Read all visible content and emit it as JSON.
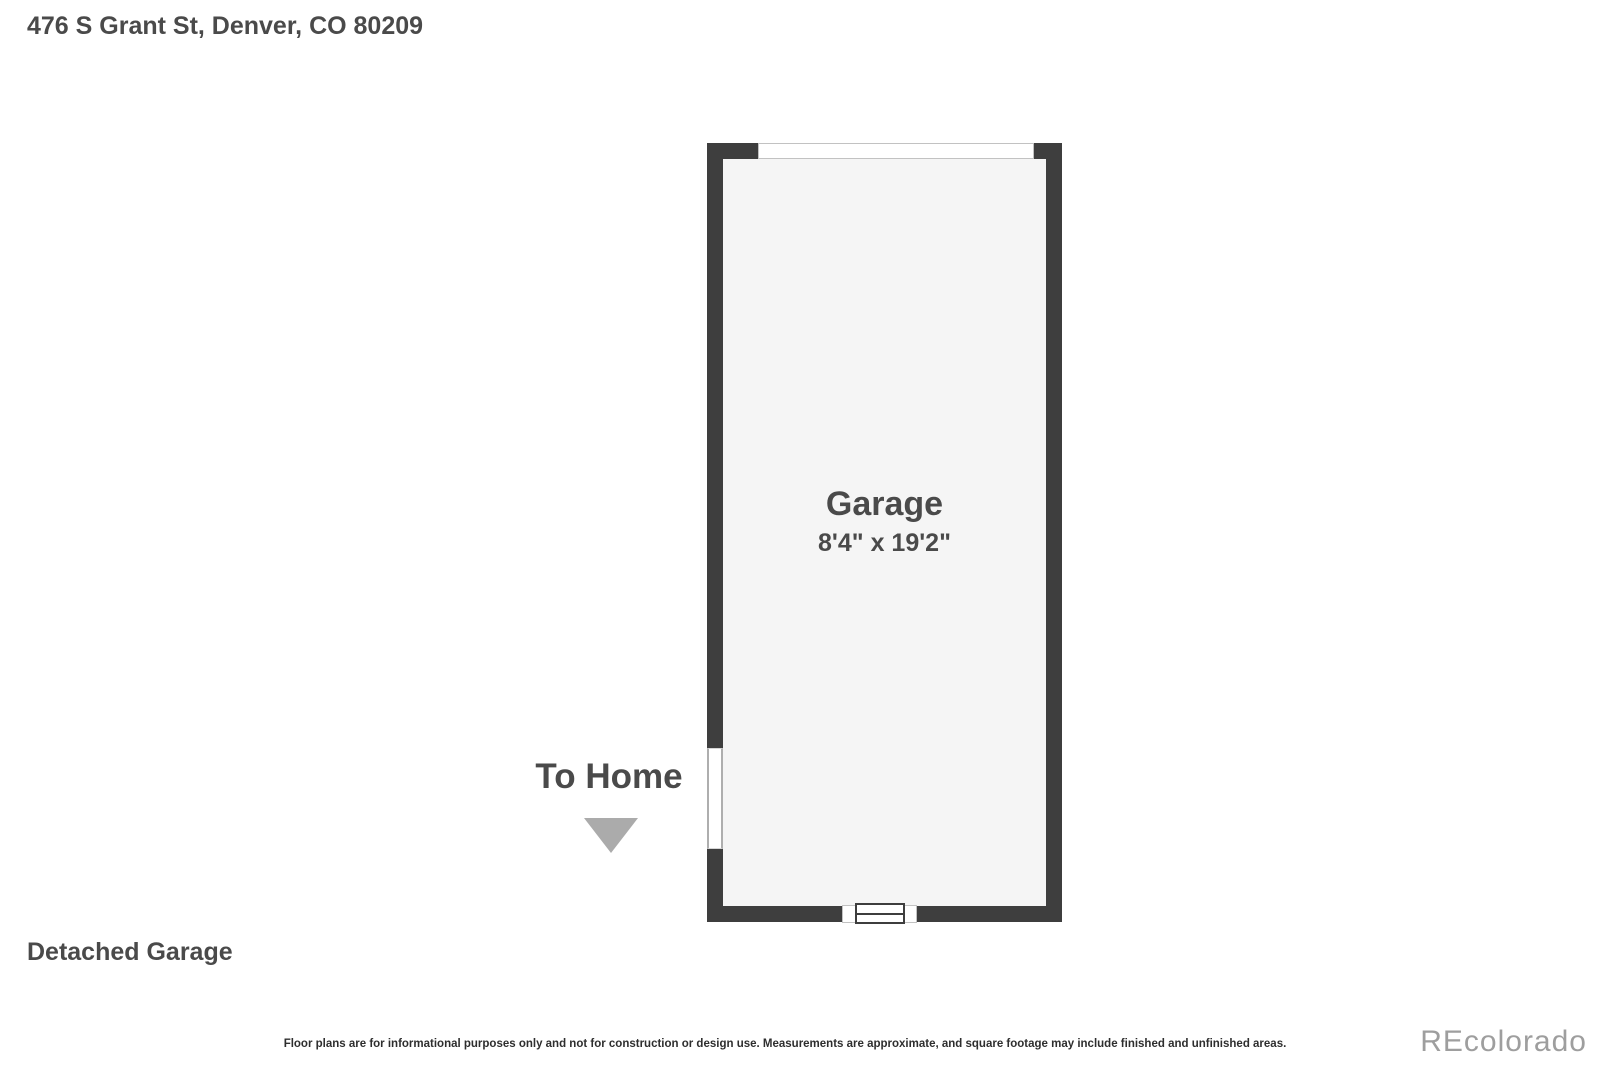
{
  "header": {
    "address": "476 S Grant St, Denver, CO 80209"
  },
  "floor_plan": {
    "room": {
      "name": "Garage",
      "dimensions": "8'4\" x 19'2\""
    },
    "to_home": {
      "label": "To Home",
      "arrow_icon": "triangle-down"
    },
    "features": {
      "top_opening": "garage-door-opening",
      "left_opening": "door-to-home-opening",
      "bottom_feature": "window"
    }
  },
  "footer": {
    "plan_label": "Detached Garage",
    "disclaimer": "Floor plans are for informational purposes only and not for construction or design use. Measurements are approximate, and square footage may include finished and unfinished areas.",
    "watermark": "REcolorado"
  },
  "colors": {
    "wall": "#3e3e3e",
    "interior": "#f5f5f5",
    "heading_text": "#4a4a4a",
    "arrow": "#ababab",
    "watermark_text": "#9e9e9e"
  }
}
